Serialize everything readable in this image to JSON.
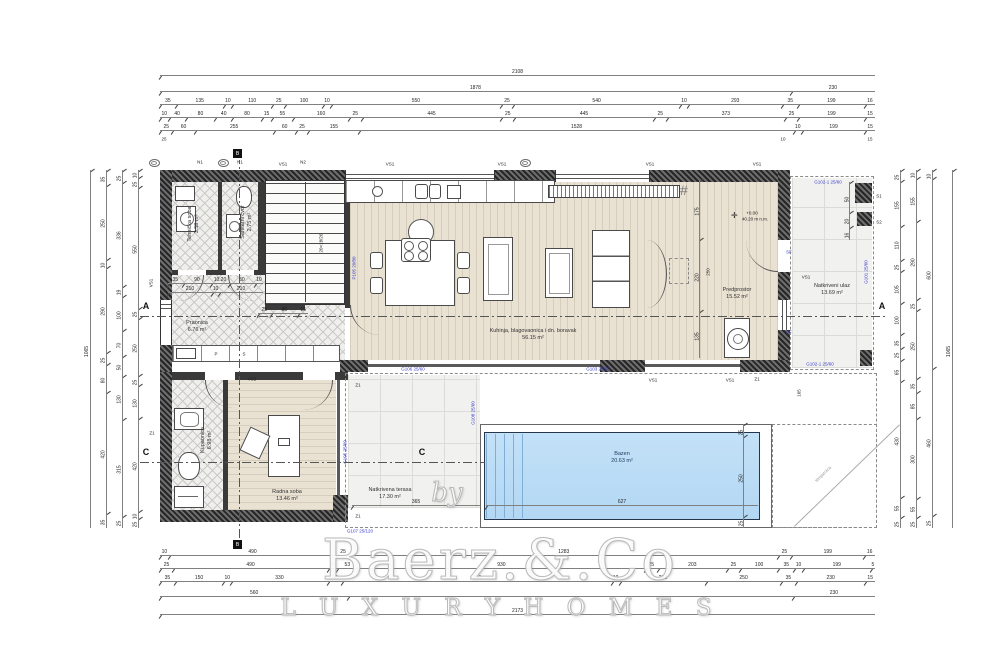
{
  "watermark": {
    "brand": "Baerz.&.Co",
    "by": "by",
    "tagline": "L U X U R Y   H O M E S"
  },
  "rooms": [
    {
      "label": "Tehnička soba",
      "area": "3.58 m²"
    },
    {
      "label": "Sanitarni čvor",
      "area": "2.75 m²"
    },
    {
      "label": "Praonica",
      "area": "6.76 m²"
    },
    {
      "label": "Kuhinja, blagovaonica i dn. boravak",
      "area": "56.15 m²"
    },
    {
      "label": "Predprostor",
      "area": "15.52 m²"
    },
    {
      "label": "Natkriveni ulaz",
      "area": "13.69 m²"
    },
    {
      "label": "Kupaonica",
      "area": "6.98 m²"
    },
    {
      "label": "Radna soba",
      "area": "13.46 m²"
    },
    {
      "label": "Natkrivena terasa",
      "area": "17.30 m²"
    },
    {
      "label": "Bazen",
      "area": "20.63 m²"
    }
  ],
  "annotations": {
    "stair_note": "20×18/26",
    "elevation": {
      "level": "+0.00",
      "datum": "40.20 m n.m."
    },
    "ramp": "strojarnica",
    "grill": "#",
    "counter_p": "P",
    "counter_s": "S",
    "beams": {
      "p105": "P105 20/80",
      "g101": "G101 25/60",
      "g102": "G102-1 25/60",
      "g103": "G103 25/60",
      "g105": "G105 25/60",
      "g106": "G106 25/60",
      "g107": "G107 25/120",
      "g108": "G108 25/60"
    },
    "tags": {
      "vs1": "VS1",
      "vs2": "VS2",
      "n1": "N1",
      "n2": "N2",
      "z1": "Z1",
      "s1": "S1",
      "s2": "S2",
      "sf": "SF"
    },
    "sections": {
      "a": "A",
      "b": "B",
      "c": "C"
    }
  },
  "dims": {
    "top_total": [
      [
        "2108",
        2108
      ]
    ],
    "top_r2": [
      [
        "1878",
        1878
      ],
      [
        "230",
        230
      ]
    ],
    "top_r3": [
      [
        "35",
        35
      ],
      [
        "135",
        135
      ],
      [
        "10",
        10
      ],
      [
        "110",
        110
      ],
      [
        "25",
        25
      ],
      [
        "100",
        100
      ],
      [
        "10",
        10
      ],
      [
        "550",
        550
      ],
      [
        "25",
        25
      ],
      [
        "540",
        540
      ],
      [
        "10",
        10
      ],
      [
        "293",
        293
      ],
      [
        "35",
        35
      ],
      [
        "199",
        199
      ],
      [
        "16",
        16
      ]
    ],
    "top_r4": [
      [
        "10",
        10
      ],
      [
        "40",
        40
      ],
      [
        "80",
        80
      ],
      [
        "40",
        40
      ],
      [
        "80",
        80
      ],
      [
        "15",
        15
      ],
      [
        "55",
        55
      ],
      [
        "160",
        160
      ],
      [
        "25",
        25
      ],
      [
        "445",
        445
      ],
      [
        "25",
        25
      ],
      [
        "445",
        445
      ],
      [
        "25",
        25
      ],
      [
        "373",
        373
      ],
      [
        "25",
        25
      ],
      [
        "199",
        199
      ],
      [
        "15",
        15
      ]
    ],
    "top_r5": [
      [
        "25",
        25
      ],
      [
        "60",
        60
      ],
      [
        "255",
        255
      ],
      [
        "60",
        60
      ],
      [
        "25",
        25
      ],
      [
        "155",
        155
      ],
      [
        "1528",
        1528
      ],
      [
        "10",
        10
      ],
      [
        "199",
        199
      ],
      [
        "15",
        15
      ]
    ],
    "bot_r1": [
      [
        "10",
        10
      ],
      [
        "490",
        490
      ],
      [
        "25",
        25
      ],
      [
        "1283",
        1283
      ],
      [
        "25",
        25
      ],
      [
        "199",
        199
      ],
      [
        "16",
        16
      ]
    ],
    "bot_r2": [
      [
        "25",
        25
      ],
      [
        "490",
        490
      ],
      [
        "10",
        10
      ],
      [
        "53",
        53
      ],
      [
        "930",
        930
      ],
      [
        "25",
        25
      ],
      [
        "203",
        203
      ],
      [
        "25",
        25
      ],
      [
        "100",
        100
      ],
      [
        "35",
        35
      ],
      [
        "10",
        10
      ],
      [
        "199",
        199
      ],
      [
        "5",
        5
      ]
    ],
    "bot_r3": [
      [
        "35",
        35
      ],
      [
        "150",
        150
      ],
      [
        "10",
        10
      ],
      [
        "330",
        330
      ],
      [
        "35",
        35
      ],
      [
        "980",
        980
      ],
      [
        "10",
        10
      ],
      [
        "293",
        293
      ],
      [
        "250",
        250
      ],
      [
        "35",
        35
      ],
      [
        "230",
        230
      ],
      [
        "15",
        15
      ]
    ],
    "bot_r4": [
      [
        "560",
        560
      ],
      [
        "",
        1383
      ],
      [
        "230",
        230
      ]
    ],
    "bot_total": [
      [
        "2173",
        2173
      ]
    ],
    "left_total": [
      [
        "1065",
        1065
      ]
    ],
    "left_c2": [
      [
        "35",
        35
      ],
      [
        "250",
        250
      ],
      [
        "10",
        10
      ],
      [
        "290",
        290
      ],
      [
        "25",
        25
      ],
      [
        "80",
        80
      ],
      [
        "420",
        420
      ],
      [
        "35",
        35
      ]
    ],
    "left_c3": [
      [
        "25",
        25
      ],
      [
        "336",
        336
      ],
      [
        "19",
        19
      ],
      [
        "100",
        100
      ],
      [
        "70",
        70
      ],
      [
        "50",
        50
      ],
      [
        "130",
        130
      ],
      [
        "315",
        315
      ],
      [
        "25",
        25
      ]
    ],
    "left_c4": [
      [
        "10",
        10
      ],
      [
        "25",
        25
      ],
      [
        "550",
        550
      ],
      [
        "25",
        25
      ],
      [
        "250",
        250
      ],
      [
        "25",
        25
      ],
      [
        "130",
        130
      ],
      [
        "420",
        420
      ],
      [
        "10",
        10
      ],
      [
        "25",
        25
      ]
    ],
    "right_c1": [
      [
        "25",
        25
      ],
      [
        "155",
        155
      ],
      [
        "110",
        110
      ],
      [
        "25",
        25
      ],
      [
        "105",
        105
      ],
      [
        "100",
        100
      ],
      [
        "35",
        35
      ],
      [
        "25",
        25
      ],
      [
        "65",
        65
      ],
      [
        "430",
        430
      ],
      [
        "55",
        55
      ],
      [
        "25",
        25
      ]
    ],
    "right_c2": [
      [
        "10",
        10
      ],
      [
        "155",
        155
      ],
      [
        "290",
        290
      ],
      [
        "25",
        25
      ],
      [
        "250",
        250
      ],
      [
        "35",
        35
      ],
      [
        "85",
        85
      ],
      [
        "300",
        300
      ],
      [
        "55",
        55
      ],
      [
        "25",
        25
      ]
    ],
    "right_c3": [
      [
        "10",
        10
      ],
      [
        "600",
        600
      ],
      [
        "460",
        460
      ],
      [
        "25",
        25
      ]
    ],
    "right_total": [
      [
        "1065",
        1065
      ]
    ],
    "hall_h1": [
      [
        "35",
        35
      ],
      [
        "90",
        90
      ],
      [
        "10.20",
        20
      ],
      [
        "80",
        80
      ],
      [
        "10",
        10
      ]
    ],
    "hall_h2": [
      [
        "210",
        210
      ],
      [
        "10",
        10
      ],
      [
        "210",
        210
      ]
    ],
    "stair_h": [
      [
        "25",
        25
      ],
      [
        "80",
        80
      ],
      [
        "15",
        15
      ]
    ],
    "vest_v": [
      [
        "175",
        175
      ],
      [
        "220",
        220
      ],
      [
        "135",
        135
      ]
    ],
    "porch_v": [
      [
        "50",
        50
      ],
      [
        "20",
        20
      ],
      [
        "16",
        16
      ]
    ],
    "pool_w": [
      [
        "627",
        627
      ]
    ],
    "pool_v": [
      [
        "25",
        25
      ],
      [
        "250",
        250
      ],
      [
        "25",
        25
      ]
    ],
    "terr_w": [
      [
        "365",
        365
      ]
    ],
    "singles": {
      "s250": "250",
      "s165": "165",
      "s25": "25",
      "s10": "10",
      "s15": "15"
    }
  }
}
